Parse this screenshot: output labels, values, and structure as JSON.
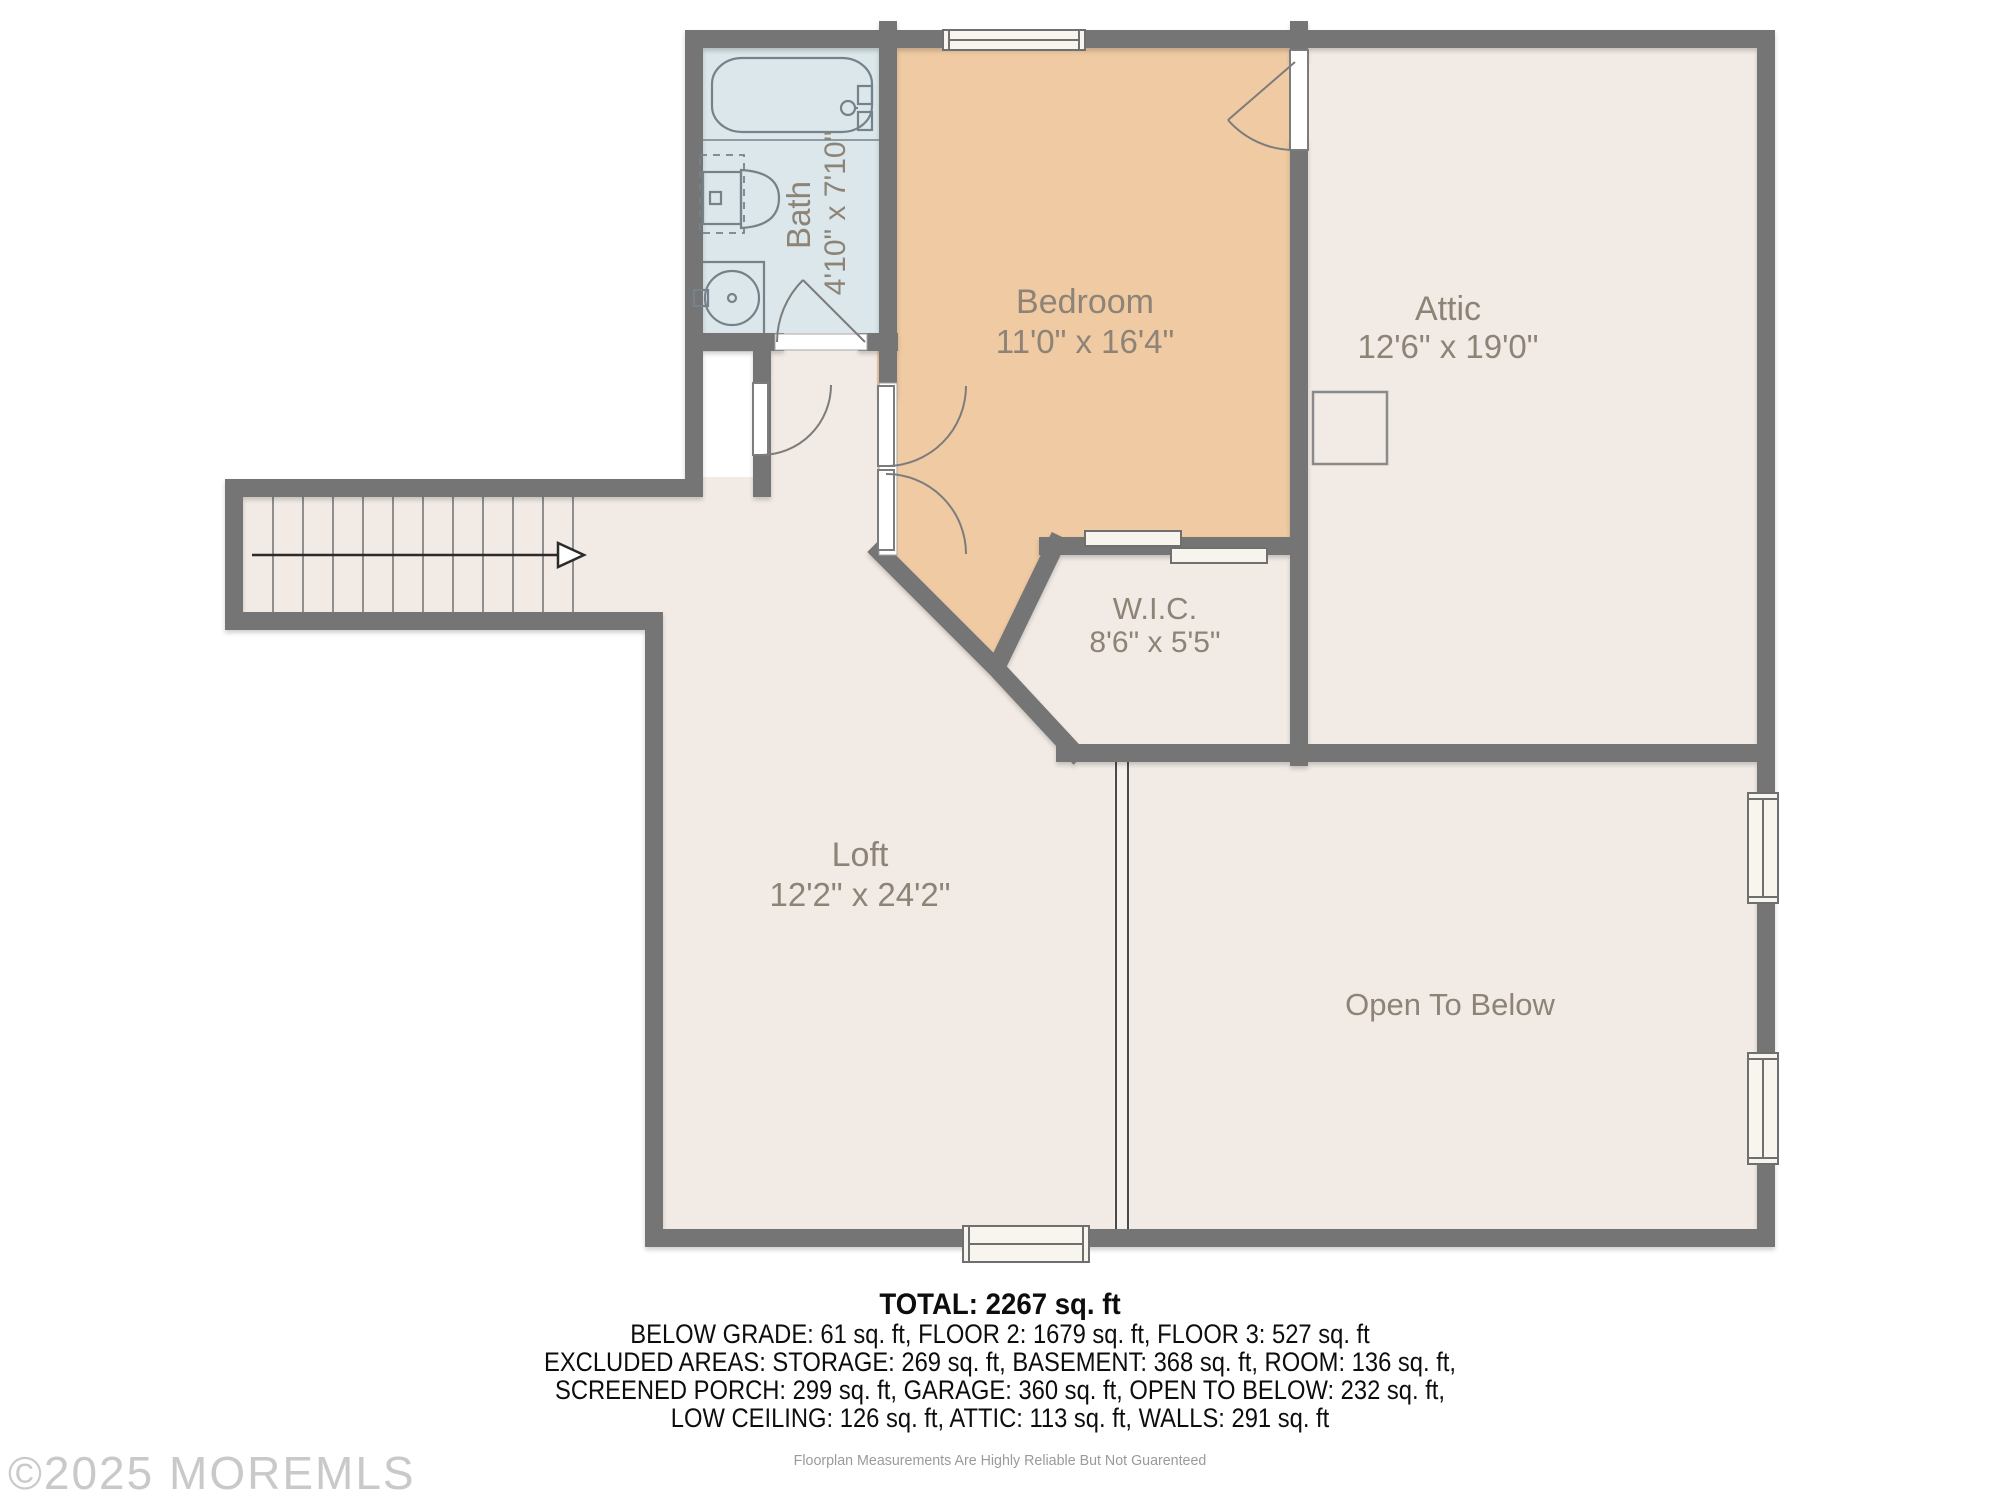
{
  "rooms": {
    "bath": {
      "name": "Bath",
      "dims": "4'10\" x 7'10\""
    },
    "bedroom": {
      "name": "Bedroom",
      "dims": "11'0\" x 16'4\""
    },
    "attic": {
      "name": "Attic",
      "dims": "12'6\" x 19'0\""
    },
    "wic": {
      "name": "W.I.C.",
      "dims": "8'6\" x 5'5\""
    },
    "loft": {
      "name": "Loft",
      "dims": "12'2\" x 24'2\""
    },
    "open_to_below": {
      "name": "Open To Below"
    }
  },
  "summary": {
    "total": "TOTAL: 2267 sq. ft",
    "line1": "BELOW GRADE: 61 sq. ft, FLOOR 2: 1679 sq. ft, FLOOR 3: 527 sq. ft",
    "line2": "EXCLUDED AREAS: STORAGE: 269 sq. ft, BASEMENT: 368 sq. ft, ROOM: 136 sq. ft,",
    "line3": "SCREENED PORCH: 299 sq. ft, GARAGE: 360 sq. ft, OPEN TO BELOW: 232 sq. ft,",
    "line4": "LOW CEILING: 126 sq. ft, ATTIC: 113 sq. ft, WALLS: 291 sq. ft"
  },
  "footer": {
    "disclaimer": "Floorplan Measurements Are Highly Reliable But Not Guarenteed"
  },
  "watermark": "©2025 MOREMLS",
  "colors": {
    "wall": "#757575",
    "floor": "#f2ebe5",
    "bedroom_floor": "#efcaa3",
    "bath_floor": "#dbe7ea",
    "label": "#8d8477",
    "fixture_line": "#75828a"
  }
}
